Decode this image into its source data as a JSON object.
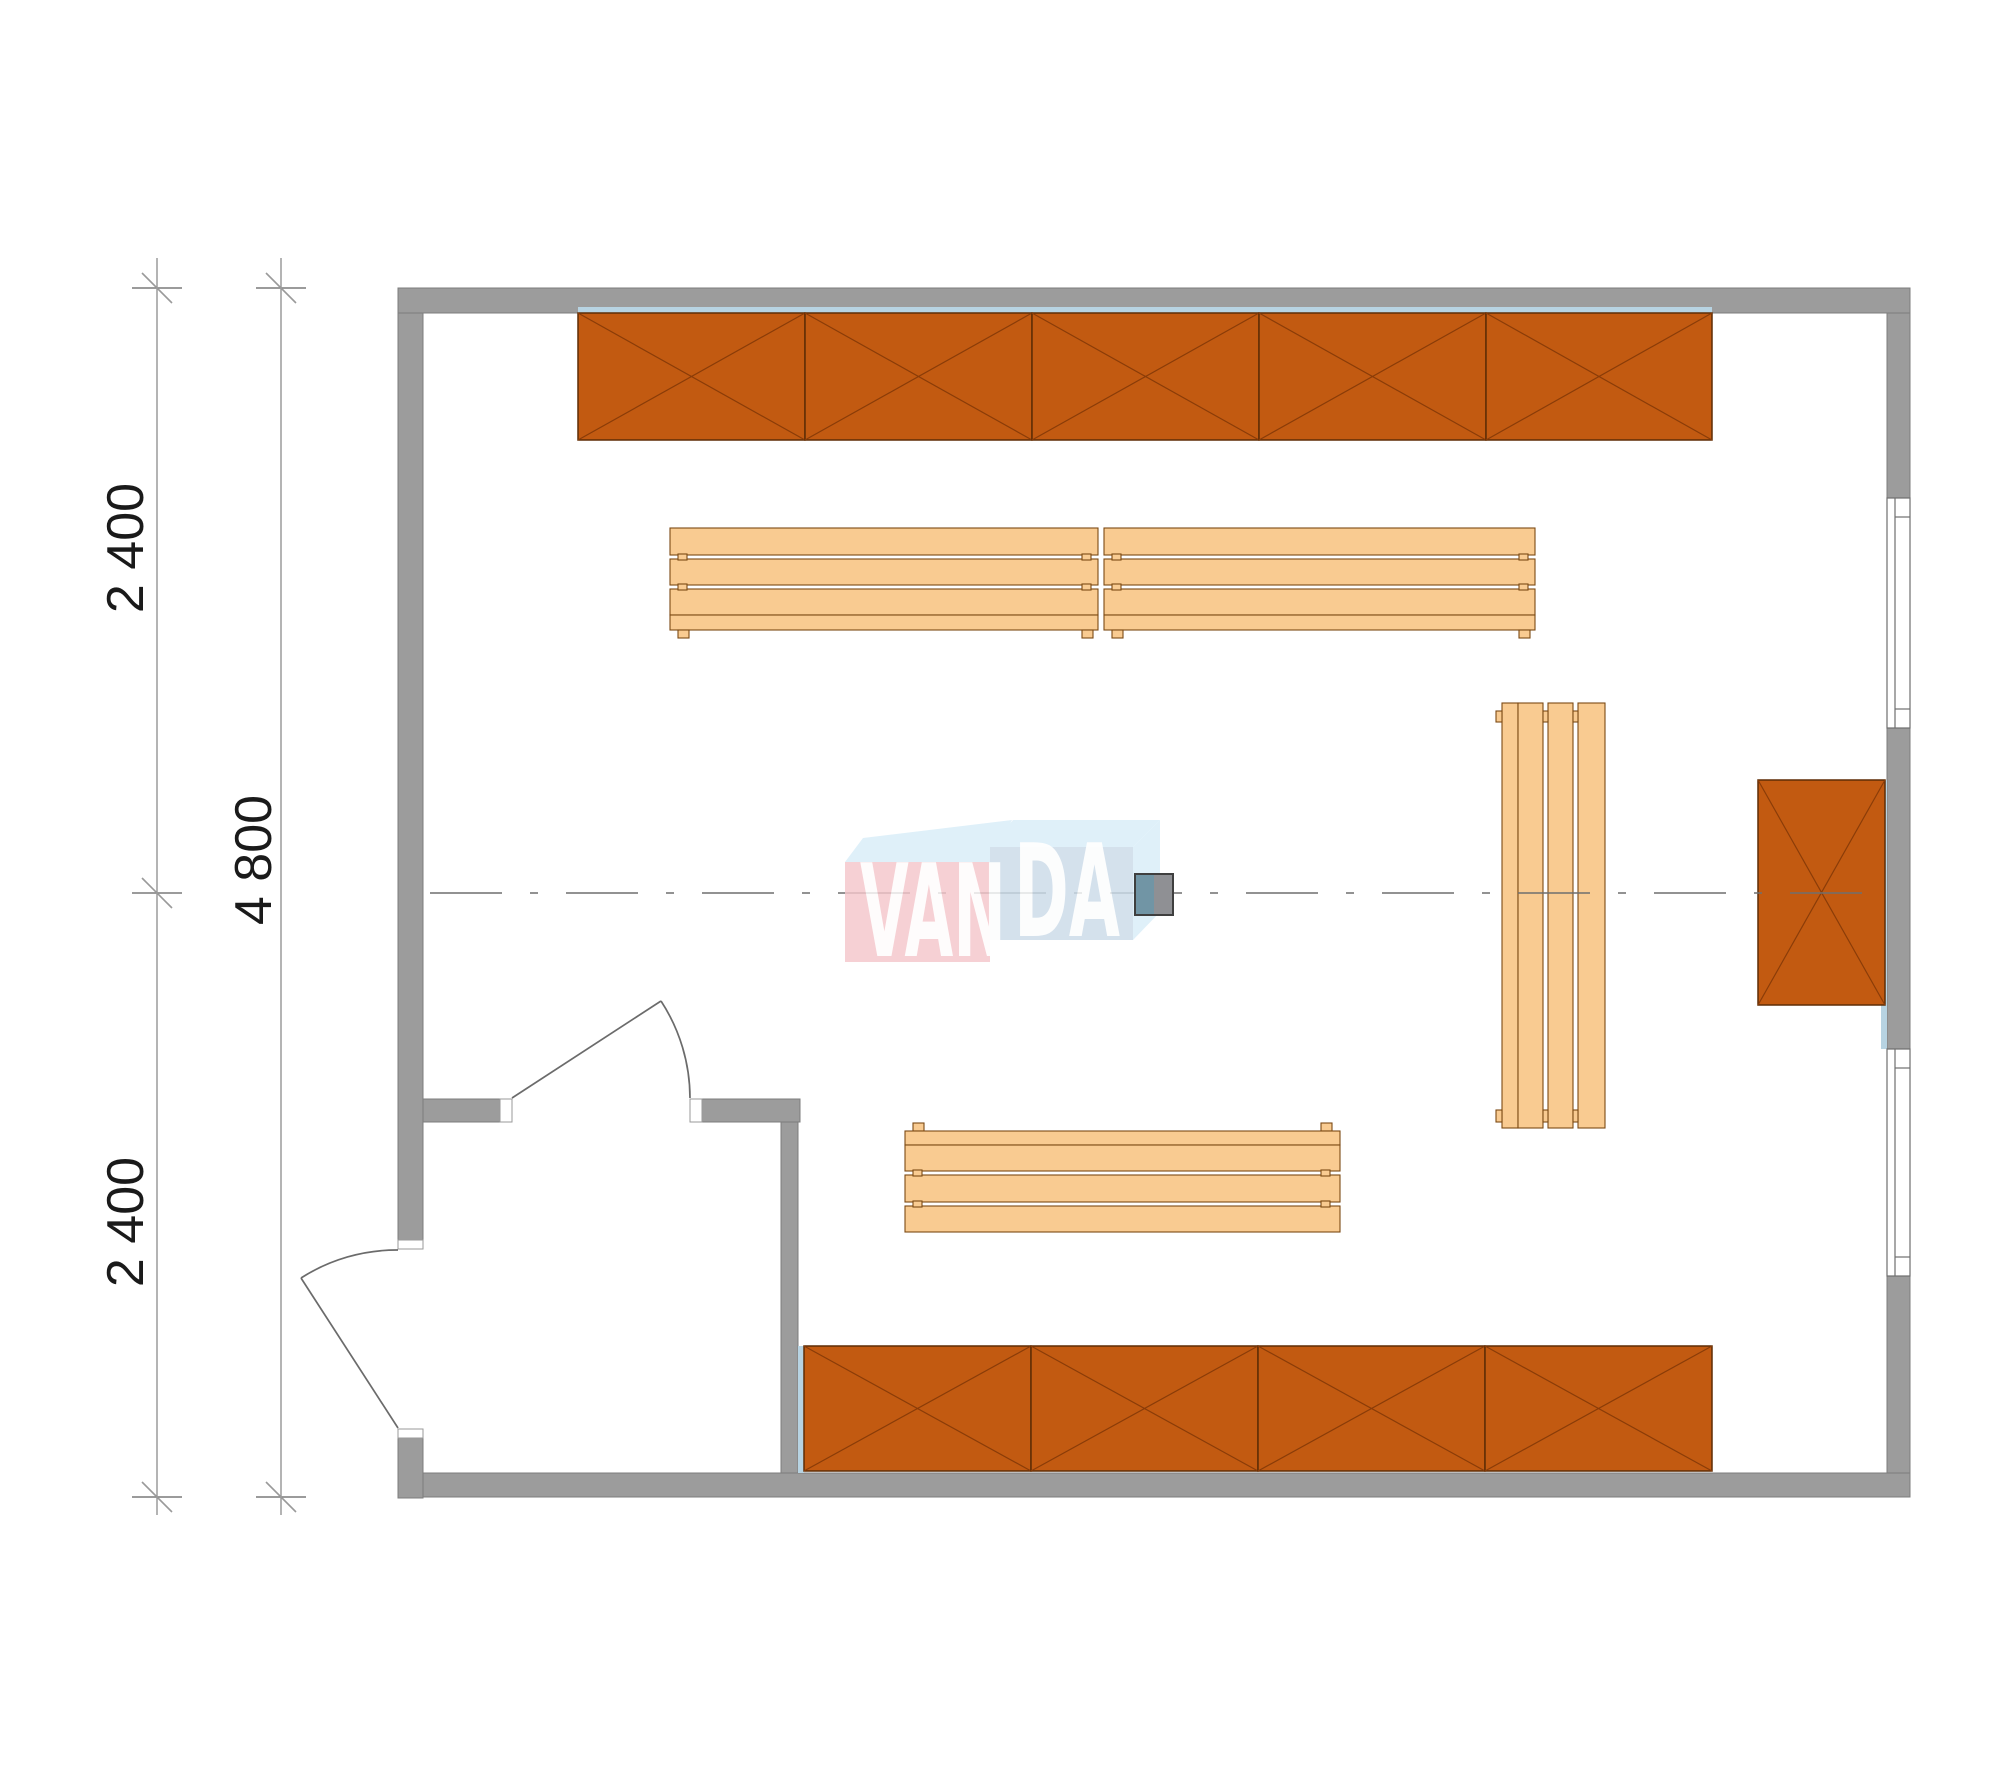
{
  "dimensions": {
    "top_segment": "2 400",
    "overall": "4 800",
    "bottom_segment": "2 400"
  },
  "watermark": {
    "text": "VANDA",
    "left_part": "VAN",
    "right_part": "DA",
    "pink": "#f5c6cb",
    "light_blue": "#d8edf8",
    "steel_blue": "#cbdbe9"
  },
  "colors": {
    "wall": "#9c9c9c",
    "counter_fill": "#c25a11",
    "counter_edge": "#5e2c05",
    "bench_fill": "#f9cb91",
    "bench_edge": "#7c4a14",
    "glass_stripe": "#b7d3e2",
    "marker_teal": "#7195a5",
    "marker_gray": "#8f9094",
    "drawing_line": "#6f6f6f",
    "text": "#1a1a1a"
  },
  "elements": {
    "crossed_counters": {
      "top_wall_segments": 5,
      "bottom_wall_segments": 4,
      "right_wall_segments": 1
    },
    "benches": 4,
    "doors": 2,
    "windows": 2
  }
}
